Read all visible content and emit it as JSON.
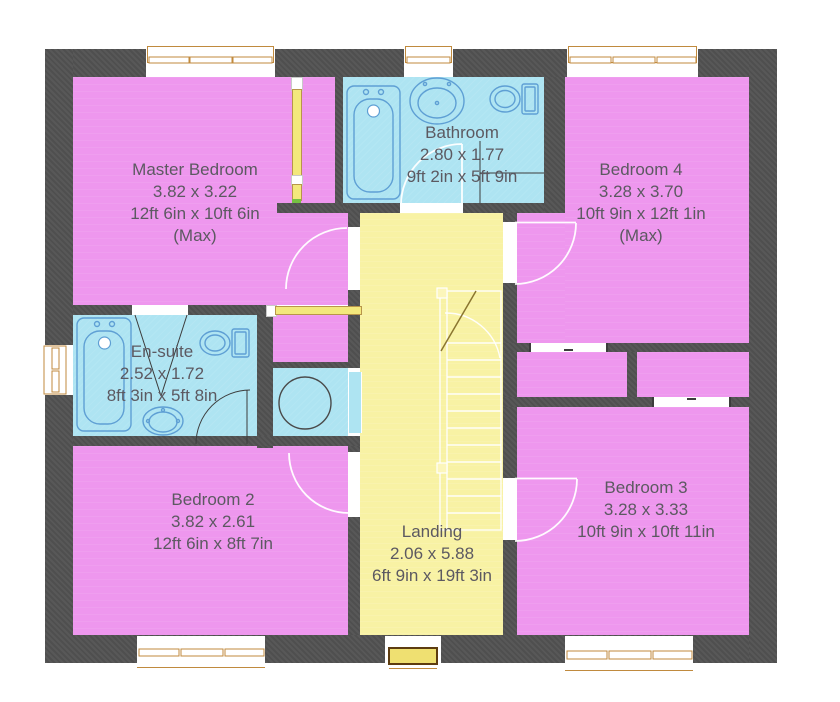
{
  "rooms": {
    "master_bedroom": {
      "name": "Master Bedroom",
      "metric": "3.82 x 3.22",
      "imperial": "12ft 6in x 10ft 6in",
      "note": "(Max)"
    },
    "bathroom": {
      "name": "Bathroom",
      "metric": "2.80 x 1.77",
      "imperial": "9ft 2in x 5ft 9in"
    },
    "bedroom_4": {
      "name": "Bedroom 4",
      "metric": "3.28 x 3.70",
      "imperial": "10ft 9in x 12ft 1in",
      "note": "(Max)"
    },
    "en_suite": {
      "name": "En-suite",
      "metric": "2.52 x 1.72",
      "imperial": "8ft 3in x 5ft 8in"
    },
    "bedroom_2": {
      "name": "Bedroom 2",
      "metric": "3.82 x 2.61",
      "imperial": "12ft 6in x 8ft 7in"
    },
    "bedroom_3": {
      "name": "Bedroom 3",
      "metric": "3.28 x 3.33",
      "imperial": "10ft 9in x 10ft 11in"
    },
    "landing": {
      "name": "Landing",
      "metric": "2.06 x 5.88",
      "imperial": "6ft 9in x 19ft 3in"
    }
  },
  "colors": {
    "wall": "#4f4f4f",
    "room_pink": "#ee97ee",
    "room_cyan": "#aee4f2",
    "room_yellow": "#f8f2a4",
    "door_yellow": "#f3e87c",
    "window_frame": "#c08a3e",
    "fixture": "#5e9fd4",
    "label_text": "#5c5961"
  }
}
